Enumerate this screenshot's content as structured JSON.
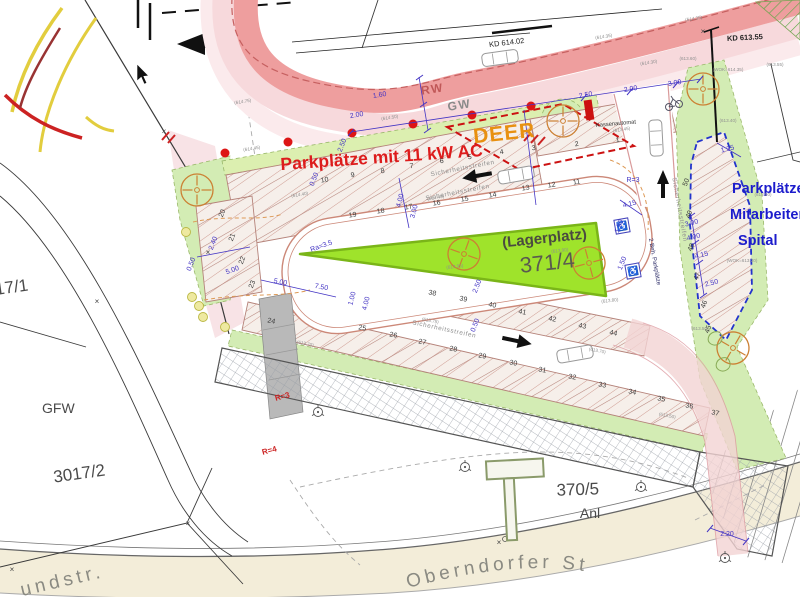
{
  "labels": {
    "main_red": "Parkplätze mit 11 kW AC",
    "deer": "DEER",
    "spital": [
      "Parkplätze",
      "Mitarbeiter",
      "Spital"
    ],
    "lagerplatz": "(Lagerplatz)",
    "parcel_371": "371/4",
    "parcel_370": "370/5",
    "anl": "Anl",
    "parcel_3017": "3017/2",
    "gfw": "GFW",
    "parcel_17": "17/1",
    "street_bottom": "Oberndorfer St",
    "street_left": "undstr.",
    "kd1": "KD 614.02",
    "kd2": "KD 613.55",
    "rw": "RW",
    "gw": "GW",
    "kassenautomat": "Kassenautomat"
  },
  "colors": {
    "rw_band": "#ee9e9e",
    "gw_band": "#f7d9dc",
    "green_area": "#d3ecb4",
    "lager_green": "#9fe32b",
    "beige_road": "#f3edd9",
    "charging_dot": "#dd1515",
    "deer_dash": "#cc1111",
    "spital_dash": "#2233cc",
    "dim_blue": "#4334c4"
  },
  "texts": {
    "stalls": [
      {
        "t": "1",
        "x": 618,
        "y": 142,
        "r": -10
      },
      {
        "t": "2",
        "x": 577,
        "y": 146,
        "r": -10
      },
      {
        "t": "3",
        "x": 534,
        "y": 150,
        "r": -10
      },
      {
        "t": "4",
        "x": 502,
        "y": 154,
        "r": -10
      },
      {
        "t": "5",
        "x": 470,
        "y": 159,
        "r": -10
      },
      {
        "t": "6",
        "x": 442,
        "y": 163,
        "r": -10
      },
      {
        "t": "7",
        "x": 412,
        "y": 168,
        "r": -10
      },
      {
        "t": "8",
        "x": 383,
        "y": 173,
        "r": -10
      },
      {
        "t": "9",
        "x": 353,
        "y": 177,
        "r": -10
      },
      {
        "t": "10",
        "x": 325,
        "y": 182,
        "r": -10
      },
      {
        "t": "11",
        "x": 577,
        "y": 184,
        "r": -10
      },
      {
        "t": "12",
        "x": 552,
        "y": 187,
        "r": -10
      },
      {
        "t": "13",
        "x": 526,
        "y": 190,
        "r": -10
      },
      {
        "t": "14",
        "x": 493,
        "y": 197,
        "r": -10
      },
      {
        "t": "15",
        "x": 465,
        "y": 201,
        "r": -10
      },
      {
        "t": "16",
        "x": 437,
        "y": 205,
        "r": -10
      },
      {
        "t": "17",
        "x": 409,
        "y": 209,
        "r": -10
      },
      {
        "t": "18",
        "x": 381,
        "y": 213,
        "r": -10
      },
      {
        "t": "19",
        "x": 353,
        "y": 217,
        "r": -10
      },
      {
        "t": "20",
        "x": 224,
        "y": 214,
        "r": -70
      },
      {
        "t": "21",
        "x": 234,
        "y": 238,
        "r": -70
      },
      {
        "t": "22",
        "x": 244,
        "y": 261,
        "r": -70
      },
      {
        "t": "23",
        "x": 254,
        "y": 285,
        "r": -70
      },
      {
        "t": "24",
        "x": 271,
        "y": 323,
        "r": 11
      },
      {
        "t": "25",
        "x": 362,
        "y": 330,
        "r": 11
      },
      {
        "t": "26",
        "x": 393,
        "y": 337,
        "r": 11
      },
      {
        "t": "27",
        "x": 422,
        "y": 344,
        "r": 11
      },
      {
        "t": "28",
        "x": 453,
        "y": 351,
        "r": 11
      },
      {
        "t": "29",
        "x": 482,
        "y": 358,
        "r": 11
      },
      {
        "t": "30",
        "x": 513,
        "y": 365,
        "r": 11
      },
      {
        "t": "31",
        "x": 542,
        "y": 372,
        "r": 11
      },
      {
        "t": "32",
        "x": 572,
        "y": 379,
        "r": 11
      },
      {
        "t": "33",
        "x": 602,
        "y": 387,
        "r": 11
      },
      {
        "t": "34",
        "x": 632,
        "y": 394,
        "r": 11
      },
      {
        "t": "35",
        "x": 661,
        "y": 401,
        "r": 11
      },
      {
        "t": "36",
        "x": 689,
        "y": 408,
        "r": 11
      },
      {
        "t": "37",
        "x": 715,
        "y": 415,
        "r": 11
      },
      {
        "t": "38",
        "x": 432,
        "y": 295,
        "r": 12
      },
      {
        "t": "39",
        "x": 463,
        "y": 301,
        "r": 12
      },
      {
        "t": "40",
        "x": 492,
        "y": 307,
        "r": 12
      },
      {
        "t": "41",
        "x": 522,
        "y": 314,
        "r": 12
      },
      {
        "t": "42",
        "x": 552,
        "y": 321,
        "r": 12
      },
      {
        "t": "43",
        "x": 582,
        "y": 328,
        "r": 12
      },
      {
        "t": "44",
        "x": 613,
        "y": 335,
        "r": 12
      },
      {
        "t": "45",
        "x": 710,
        "y": 330,
        "r": -70
      },
      {
        "t": "46",
        "x": 706,
        "y": 305,
        "r": -70
      },
      {
        "t": "47",
        "x": 699,
        "y": 277,
        "r": -70
      },
      {
        "t": "48",
        "x": 693,
        "y": 248,
        "r": -70
      },
      {
        "t": "49",
        "x": 691,
        "y": 215,
        "r": -70
      },
      {
        "t": "50",
        "x": 688,
        "y": 183,
        "r": -70
      }
    ],
    "dims": [
      {
        "t": "1.60",
        "x": 380,
        "y": 97,
        "r": -10
      },
      {
        "t": "2.00",
        "x": 357,
        "y": 117,
        "r": -10
      },
      {
        "t": "2.50",
        "x": 344,
        "y": 146,
        "r": -68
      },
      {
        "t": "2.50",
        "x": 586,
        "y": 97,
        "r": -10
      },
      {
        "t": "2.00",
        "x": 631,
        "y": 91,
        "r": -10
      },
      {
        "t": "3.00",
        "x": 675,
        "y": 85,
        "r": -10
      },
      {
        "t": "1.35",
        "x": 728,
        "y": 151,
        "r": -14
      },
      {
        "t": "0.50",
        "x": 316,
        "y": 180,
        "r": -68
      },
      {
        "t": "4.00",
        "x": 402,
        "y": 201,
        "r": -75
      },
      {
        "t": "3.00",
        "x": 416,
        "y": 212,
        "r": -75
      },
      {
        "t": "0.50",
        "x": 193,
        "y": 265,
        "r": -68
      },
      {
        "t": "2.40",
        "x": 215,
        "y": 244,
        "r": -68
      },
      {
        "t": "5.00",
        "x": 233,
        "y": 272,
        "r": -20
      },
      {
        "t": "5.00",
        "x": 280,
        "y": 284,
        "r": 11
      },
      {
        "t": "7.50",
        "x": 321,
        "y": 289,
        "r": 11
      },
      {
        "t": "1.00",
        "x": 354,
        "y": 299,
        "r": -75
      },
      {
        "t": "4.00",
        "x": 368,
        "y": 304,
        "r": -75
      },
      {
        "t": "4.15",
        "x": 630,
        "y": 206,
        "r": -14
      },
      {
        "t": "1.50",
        "x": 621,
        "y": 227,
        "r": -68
      },
      {
        "t": "1.50",
        "x": 624,
        "y": 264,
        "r": -68
      },
      {
        "t": "3.00",
        "x": 692,
        "y": 225,
        "r": -14
      },
      {
        "t": "4.00",
        "x": 694,
        "y": 239,
        "r": -14
      },
      {
        "t": "4.15",
        "x": 702,
        "y": 257,
        "r": -14
      },
      {
        "t": "2.50",
        "x": 712,
        "y": 285,
        "r": -14
      },
      {
        "t": "2.50",
        "x": 479,
        "y": 287,
        "r": -68
      },
      {
        "t": "0.50",
        "x": 477,
        "y": 326,
        "r": -68
      },
      {
        "t": "2.20",
        "x": 727,
        "y": 536,
        "r": 0
      }
    ],
    "elevs": [
      {
        "t": "(614.75)",
        "x": 243,
        "y": 103,
        "r": -9
      },
      {
        "t": "(614.50)",
        "x": 390,
        "y": 119,
        "r": -9
      },
      {
        "t": "(614.35)",
        "x": 604,
        "y": 38,
        "r": -9
      },
      {
        "t": "(614.30)",
        "x": 649,
        "y": 64,
        "r": -9
      },
      {
        "t": "(614.35)",
        "x": 694,
        "y": 20,
        "r": -9
      },
      {
        "t": "(614.45)",
        "x": 252,
        "y": 150,
        "r": -9
      },
      {
        "t": "(614.40)",
        "x": 300,
        "y": 196,
        "r": -9
      },
      {
        "t": "(614.40)",
        "x": 436,
        "y": 199,
        "r": -9
      },
      {
        "t": "(613.90)",
        "x": 560,
        "y": 252,
        "r": -7
      },
      {
        "t": "(613.95)",
        "x": 455,
        "y": 268,
        "r": -7
      },
      {
        "t": "(613.80)",
        "x": 610,
        "y": 302,
        "r": -7
      },
      {
        "t": "(613.75)",
        "x": 430,
        "y": 322,
        "r": 11
      },
      {
        "t": "(613.70)",
        "x": 597,
        "y": 352,
        "r": 11
      },
      {
        "t": "(613.70)",
        "x": 305,
        "y": 345,
        "r": 11
      },
      {
        "t": "(613.50)",
        "x": 667,
        "y": 417,
        "r": 11
      },
      {
        "t": "(613.50)",
        "x": 700,
        "y": 330,
        "r": 0
      },
      {
        "t": "(613.50)",
        "x": 763,
        "y": 196,
        "r": 0
      },
      {
        "t": "(613.60)",
        "x": 688,
        "y": 60,
        "r": 0
      },
      {
        "t": "(613.55)",
        "x": 775,
        "y": 66,
        "r": 0
      },
      {
        "t": "(613.40)",
        "x": 728,
        "y": 122,
        "r": 0
      },
      {
        "t": "(613.45)",
        "x": 622,
        "y": 131,
        "r": -9
      },
      {
        "t": "(WOK=614.35)",
        "x": 728,
        "y": 71,
        "r": 0
      },
      {
        "t": "(WOK=613.20)",
        "x": 742,
        "y": 262,
        "r": 0
      }
    ],
    "safety": [
      {
        "t": "Sicherheitsstreifen",
        "x": 463,
        "y": 170,
        "r": -11
      },
      {
        "t": "Sicherheitsstreifen",
        "x": 458,
        "y": 194,
        "r": -11
      },
      {
        "t": "Sicherheitsstreifen",
        "x": 444,
        "y": 331,
        "r": 12
      },
      {
        "t": "Sicherheitsstreifen",
        "x": 678,
        "y": 210,
        "r": 80
      },
      {
        "t": "2 Beh. Parkplätze",
        "x": 653,
        "y": 262,
        "r": 80,
        "c": "beh"
      }
    ],
    "radius": [
      {
        "t": "Ra=3.5",
        "x": 322,
        "y": 248,
        "r": -20,
        "c": "rlabel-blue"
      },
      {
        "t": "R=3",
        "x": 633,
        "y": 182,
        "r": 0,
        "c": "rlabel-blue"
      },
      {
        "t": "R=3",
        "x": 283,
        "y": 399,
        "r": -15,
        "c": "rlabel-red"
      },
      {
        "t": "R=4",
        "x": 270,
        "y": 453,
        "r": -15,
        "c": "rlabel-red"
      }
    ],
    "marks": [
      {
        "t": "×",
        "x": 164,
        "y": 134,
        "r": 0
      },
      {
        "t": "×",
        "x": 208,
        "y": 255,
        "r": 0
      },
      {
        "t": "×",
        "x": 97,
        "y": 304,
        "r": 0
      },
      {
        "t": "×",
        "x": 12,
        "y": 572,
        "r": 0
      },
      {
        "t": "×",
        "x": 188,
        "y": 526,
        "r": 0
      },
      {
        "t": "×",
        "x": 499,
        "y": 545,
        "r": 0
      },
      {
        "t": "×",
        "x": 703,
        "y": 34,
        "r": 0
      }
    ]
  }
}
